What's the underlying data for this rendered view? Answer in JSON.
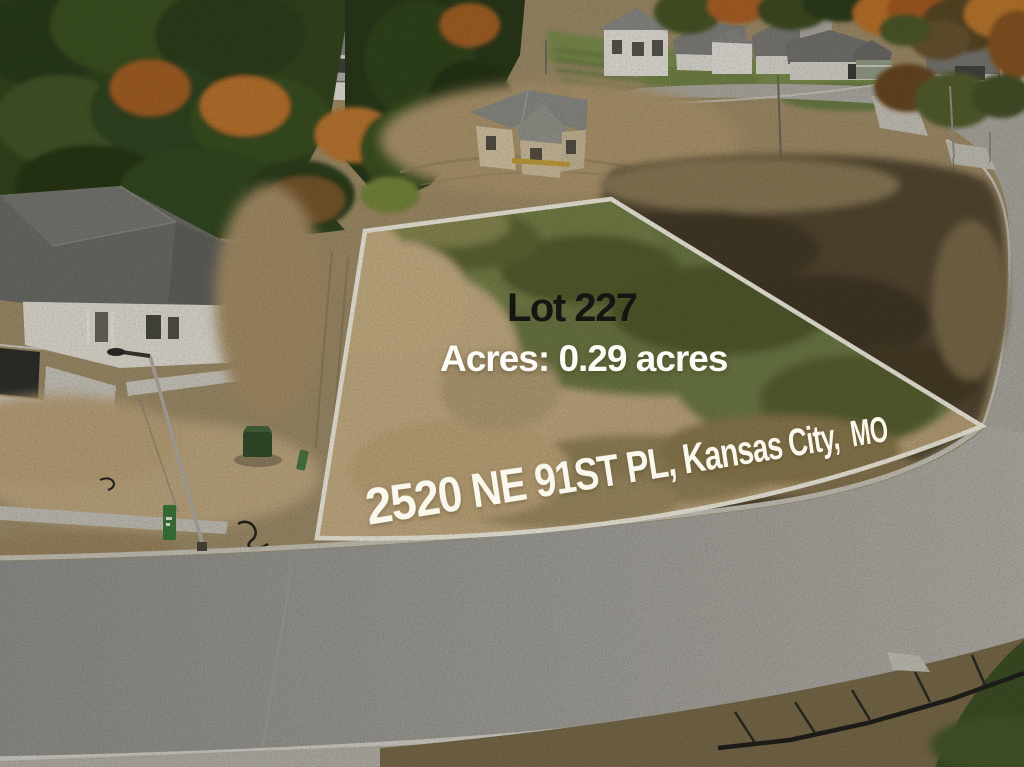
{
  "overlay": {
    "lot_label": "Lot 227",
    "acres_label": "Acres: 0.29 acres",
    "address_label": "2520 NE 91ST PL, Kansas City,  MO"
  },
  "lot": {
    "number": "227",
    "acres": "0.29",
    "street": "2520 NE 91ST PL",
    "city": "Kansas City",
    "state": "MO"
  },
  "colors": {
    "outline": "#f6f2e4",
    "lot_text": "#171512",
    "white_text": "#fcfbf6"
  }
}
